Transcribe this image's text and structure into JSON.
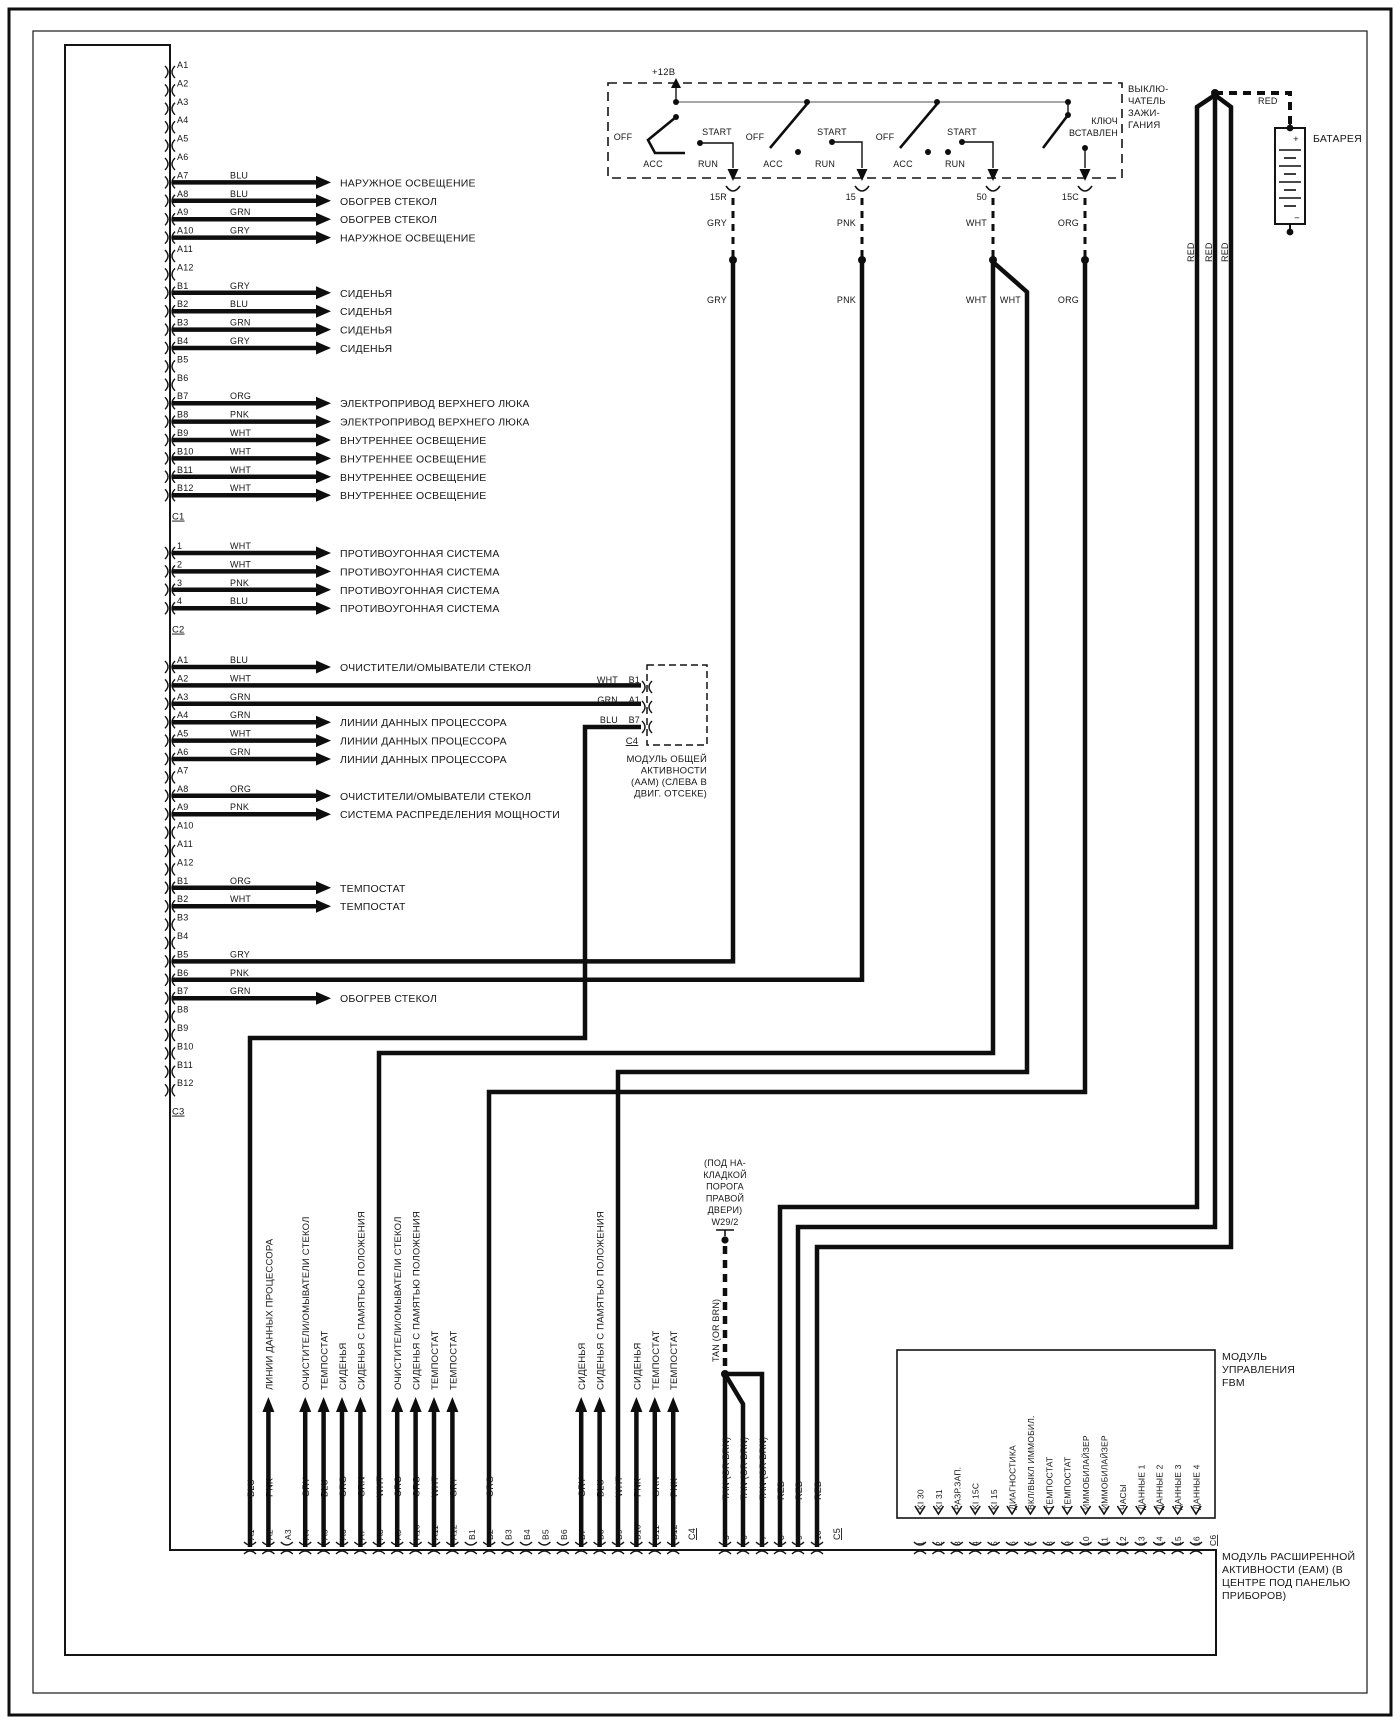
{
  "ignition": {
    "title_lines": [
      "ВЫКЛЮ-",
      "ЧАТЕЛЬ",
      "ЗАЖИ-",
      "ГАНИЯ"
    ],
    "supply_label": "+12В",
    "positions_labels": {
      "off": "OFF",
      "acc": "ACC",
      "start": "START",
      "run": "RUN"
    },
    "key_lines": [
      "КЛЮЧ",
      "ВСТАВЛЕН"
    ],
    "terminals": [
      {
        "id": "15R",
        "color": "GRY"
      },
      {
        "id": "15",
        "color": "PNK"
      },
      {
        "id": "50",
        "color": "WHT",
        "color2": "WHT"
      },
      {
        "id": "15C",
        "color": "ORG"
      }
    ]
  },
  "battery": {
    "label": "БАТАРЕЯ",
    "plus": "+",
    "minus": "−",
    "top_wire_color": "RED",
    "riser_colors": [
      "RED",
      "RED",
      "RED"
    ]
  },
  "left_connector": {
    "sections": [
      {
        "connector_id": "C1",
        "pins": [
          {
            "id": "A1"
          },
          {
            "id": "A2"
          },
          {
            "id": "A3"
          },
          {
            "id": "A4"
          },
          {
            "id": "A5"
          },
          {
            "id": "A6"
          },
          {
            "id": "A7",
            "color": "BLU",
            "label": "НАРУЖНОЕ ОСВЕЩЕНИЕ"
          },
          {
            "id": "A8",
            "color": "BLU",
            "label": "ОБОГРЕВ СТЕКОЛ"
          },
          {
            "id": "A9",
            "color": "GRN",
            "label": "ОБОГРЕВ СТЕКОЛ"
          },
          {
            "id": "A10",
            "color": "GRY",
            "label": "НАРУЖНОЕ ОСВЕЩЕНИЕ"
          },
          {
            "id": "A11"
          },
          {
            "id": "A12"
          },
          {
            "id": "B1",
            "color": "GRY",
            "label": "СИДЕНЬЯ"
          },
          {
            "id": "B2",
            "color": "BLU",
            "label": "СИДЕНЬЯ"
          },
          {
            "id": "B3",
            "color": "GRN",
            "label": "СИДЕНЬЯ"
          },
          {
            "id": "B4",
            "color": "GRY",
            "label": "СИДЕНЬЯ"
          },
          {
            "id": "B5"
          },
          {
            "id": "B6"
          },
          {
            "id": "B7",
            "color": "ORG",
            "label": "ЭЛЕКТРОПРИВОД ВЕРХНЕГО ЛЮКА"
          },
          {
            "id": "B8",
            "color": "PNK",
            "label": "ЭЛЕКТРОПРИВОД ВЕРХНЕГО ЛЮКА"
          },
          {
            "id": "B9",
            "color": "WHT",
            "label": "ВНУТРЕННЕЕ ОСВЕЩЕНИЕ"
          },
          {
            "id": "B10",
            "color": "WHT",
            "label": "ВНУТРЕННЕЕ ОСВЕЩЕНИЕ"
          },
          {
            "id": "B11",
            "color": "WHT",
            "label": "ВНУТРЕННЕЕ ОСВЕЩЕНИЕ"
          },
          {
            "id": "B12",
            "color": "WHT",
            "label": "ВНУТРЕННЕЕ ОСВЕЩЕНИЕ"
          }
        ]
      },
      {
        "connector_id": "C2",
        "pins": [
          {
            "id": "1",
            "color": "WHT",
            "label": "ПРОТИВОУГОННАЯ СИСТЕМА"
          },
          {
            "id": "2",
            "color": "WHT",
            "label": "ПРОТИВОУГОННАЯ СИСТЕМА"
          },
          {
            "id": "3",
            "color": "PNK",
            "label": "ПРОТИВОУГОННАЯ СИСТЕМА"
          },
          {
            "id": "4",
            "color": "BLU",
            "label": "ПРОТИВОУГОННАЯ СИСТЕМА"
          }
        ]
      },
      {
        "connector_id": "C3",
        "pins": [
          {
            "id": "A1",
            "color": "BLU",
            "label": "ОЧИСТИТЕЛИ/ОМЫВАТЕЛИ СТЕКОЛ"
          },
          {
            "id": "A2",
            "color": "WHT",
            "route": "aam_b1"
          },
          {
            "id": "A3",
            "color": "GRN",
            "route": "aam_a1"
          },
          {
            "id": "A4",
            "color": "GRN",
            "label": "ЛИНИИ ДАННЫХ ПРОЦЕССОРА"
          },
          {
            "id": "A5",
            "color": "WHT",
            "label": "ЛИНИИ ДАННЫХ ПРОЦЕССОРА"
          },
          {
            "id": "A6",
            "color": "GRN",
            "label": "ЛИНИИ ДАННЫХ ПРОЦЕССОРА"
          },
          {
            "id": "A7"
          },
          {
            "id": "A8",
            "color": "ORG",
            "label": "ОЧИСТИТЕЛИ/ОМЫВАТЕЛИ СТЕКОЛ"
          },
          {
            "id": "A9",
            "color": "PNK",
            "label": "СИСТЕМА РАСПРЕДЕЛЕНИЯ МОЩНОСТИ"
          },
          {
            "id": "A10"
          },
          {
            "id": "A11"
          },
          {
            "id": "A12"
          },
          {
            "id": "B1",
            "color": "ORG",
            "label": "ТЕМПОСТАТ"
          },
          {
            "id": "B2",
            "color": "WHT",
            "label": "ТЕМПОСТАТ"
          },
          {
            "id": "B3"
          },
          {
            "id": "B4"
          },
          {
            "id": "B5",
            "color": "GRY",
            "route": "ign_15R"
          },
          {
            "id": "B6",
            "color": "PNK",
            "route": "ign_15"
          },
          {
            "id": "B7",
            "color": "GRN",
            "label": "ОБОГРЕВ СТЕКОЛ"
          },
          {
            "id": "B8"
          },
          {
            "id": "B9"
          },
          {
            "id": "B10"
          },
          {
            "id": "B11"
          },
          {
            "id": "B12"
          }
        ]
      }
    ]
  },
  "aam": {
    "pins": [
      {
        "color": "WHT",
        "id": "B1"
      },
      {
        "color": "GRN",
        "id": "A1"
      },
      {
        "color": "BLU",
        "id": "B7"
      }
    ],
    "connector_id": "C4",
    "label_lines": [
      "МОДУЛЬ ОБЩЕЙ",
      "АКТИВНОСТИ",
      "(ААМ) (СЛЕВА В",
      "ДВИГ. ОТСЕКЕ)"
    ]
  },
  "w29": {
    "lines": [
      "(ПОД НА-",
      "КЛАДКОЙ",
      "ПОРОГА",
      "ПРАВОЙ",
      "ДВЕРИ)",
      "W29/2"
    ],
    "wire_color": "TAN  (OR BRN)"
  },
  "bottom_connector": {
    "pins": [
      {
        "id": "A1",
        "color": "BLU"
      },
      {
        "id": "A2",
        "color": "PNK",
        "label": "ЛИНИИ ДАННЫХ ПРОЦЕССОРА"
      },
      {
        "id": "A3"
      },
      {
        "id": "A4",
        "color": "GRY",
        "label": "ОЧИСТИТЕЛИ/ОМЫВАТЕЛИ СТЕКОЛ"
      },
      {
        "id": "A5",
        "color": "BLU",
        "label": "ТЕМПОСТАТ"
      },
      {
        "id": "A6",
        "color": "ORG",
        "label": "СИДЕНЬЯ"
      },
      {
        "id": "A7",
        "color": "GRN",
        "label": "СИДЕНЬЯ С ПАМЯТЬЮ ПОЛОЖЕНИЯ"
      },
      {
        "id": "A8",
        "color": "WHT"
      },
      {
        "id": "A9",
        "color": "ORG",
        "label": "ОЧИСТИТЕЛИ/ОМЫВАТЕЛИ СТЕКОЛ"
      },
      {
        "id": "A10",
        "color": "ORG",
        "label": "СИДЕНЬЯ С ПАМЯТЬЮ ПОЛОЖЕНИЯ"
      },
      {
        "id": "A11",
        "color": "WHT",
        "label": "ТЕМПОСТАТ"
      },
      {
        "id": "A12",
        "color": "GRY",
        "label": "ТЕМПОСТАТ"
      },
      {
        "id": "B1"
      },
      {
        "id": "B2",
        "color": "ORG"
      },
      {
        "id": "B3"
      },
      {
        "id": "B4"
      },
      {
        "id": "B5"
      },
      {
        "id": "B6"
      },
      {
        "id": "B7",
        "color": "GRY",
        "label": "СИДЕНЬЯ"
      },
      {
        "id": "B8",
        "color": "BLU",
        "label": "СИДЕНЬЯ С ПАМЯТЬЮ ПОЛОЖЕНИЯ"
      },
      {
        "id": "B9",
        "color": "WHT"
      },
      {
        "id": "B10",
        "color": "PNK",
        "label": "СИДЕНЬЯ"
      },
      {
        "id": "B11",
        "color": "GRN",
        "label": "ТЕМПОСТАТ"
      },
      {
        "id": "B12",
        "color": "PNK",
        "label": "ТЕМПОСТАТ"
      }
    ],
    "connector_id": "C4",
    "aux_pins": [
      {
        "id": "5",
        "color": "TAN  (OR BRN)"
      },
      {
        "id": "6",
        "color": "TAN  (OR BRN)"
      },
      {
        "id": "7",
        "color": "TAN  (OR BRN)"
      },
      {
        "id": "8",
        "color": "RED"
      },
      {
        "id": "9",
        "color": "RED"
      },
      {
        "id": "10",
        "color": "RED"
      }
    ],
    "aux_connector_id": "C5"
  },
  "fbm": {
    "pins": [
      {
        "num": "1",
        "label": "KI 30"
      },
      {
        "num": "2",
        "label": "KI 31"
      },
      {
        "num": "3",
        "label": "РАЗР.ЗАП."
      },
      {
        "num": "4",
        "label": "KI 15C"
      },
      {
        "num": "5",
        "label": "KI 15"
      },
      {
        "num": "6",
        "label": "ДИАГНОСТИКА"
      },
      {
        "num": "7",
        "label": "ВКЛ/ВЫКЛ ИММОБИЛ."
      },
      {
        "num": "8",
        "label": "ТЕМПОСТАТ"
      },
      {
        "num": "9",
        "label": "ТЕМПОСТАТ"
      },
      {
        "num": "10",
        "label": "ИММОБИЛАЙЗЕР"
      },
      {
        "num": "11",
        "label": "ИММОБИЛАЙЗЕР"
      },
      {
        "num": "12",
        "label": "ЧАСЫ"
      },
      {
        "num": "13",
        "label": "ДАННЫЕ 1"
      },
      {
        "num": "14",
        "label": "ДАННЫЕ 2"
      },
      {
        "num": "15",
        "label": "ДАННЫЕ 3"
      },
      {
        "num": "16",
        "label": "ДАННЫЕ 4"
      }
    ],
    "connector_id": "C6",
    "label_lines": [
      "МОДУЛЬ",
      "УПРАВЛЕНИЯ",
      "FBM"
    ]
  },
  "eam": {
    "label_lines": [
      "МОДУЛЬ РАСШИРЕННОЙ",
      "АКТИВНОСТИ (ЕАМ) (В",
      "ЦЕНТРЕ ПОД ПАНЕЛЬЮ",
      "ПРИБОРОВ)"
    ]
  }
}
